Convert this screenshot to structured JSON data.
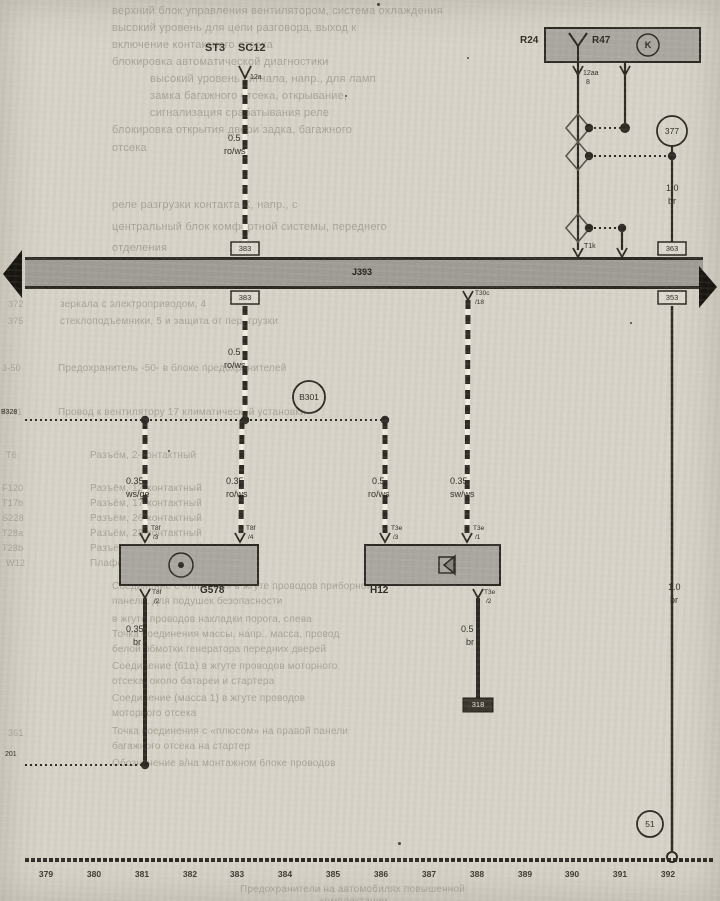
{
  "fuse": {
    "st3": "ST3",
    "sc12": "SC12",
    "pin": "12a"
  },
  "relay": {
    "r24": "R24",
    "r47": "R47",
    "k": "K",
    "pin": "12aa",
    "pin_n": "8"
  },
  "bus": {
    "label": "J393",
    "pin_t1k": "T1k",
    "pin_t30c": "T30c",
    "pin_t30c_n": "/18",
    "ref_left_above": "383",
    "ref_left_below": "383",
    "ref_right_above": "363",
    "ref_right_below": "353"
  },
  "sensor": {
    "label": "G578",
    "pin_tl": "T8f",
    "pin_tl_n": "/3",
    "pin_tr": "T8f",
    "pin_tr_n": "/4",
    "pin_b": "T8f",
    "pin_b_n": "/2"
  },
  "horn": {
    "label": "H12",
    "pin_tl": "T3e",
    "pin_tl_n": "/3",
    "pin_tr": "T3e",
    "pin_tr_n": "/1",
    "pin_b": "T3e",
    "pin_b_n": "/2",
    "end_ref": "318"
  },
  "splices": {
    "b301": "B301",
    "b328": "B328",
    "left_bottom": "201",
    "c377": "377",
    "c51": "51"
  },
  "wires": {
    "w1": {
      "g": "0.5",
      "c": "ro/ws"
    },
    "w2": {
      "g": "0.5",
      "c": "ro/ws"
    },
    "w3": {
      "g": "0.35",
      "c": "ws/ge"
    },
    "w4": {
      "g": "0.35",
      "c": "ro/ws"
    },
    "w5": {
      "g": "0.5",
      "c": "ro/ws"
    },
    "w6": {
      "g": "0.35",
      "c": "sw/ws"
    },
    "w7": {
      "g": "0.35",
      "c": "br"
    },
    "w8": {
      "g": "0.5",
      "c": "br"
    },
    "w9": {
      "g": "1.0",
      "c": "br"
    },
    "w10": {
      "g": "1.0",
      "c": "br"
    }
  },
  "tracks": [
    {
      "x": 46,
      "t": "379"
    },
    {
      "x": 94,
      "t": "380"
    },
    {
      "x": 142,
      "t": "381"
    },
    {
      "x": 190,
      "t": "382"
    },
    {
      "x": 237,
      "t": "383"
    },
    {
      "x": 285,
      "t": "384"
    },
    {
      "x": 333,
      "t": "385"
    },
    {
      "x": 381,
      "t": "386"
    },
    {
      "x": 429,
      "t": "387"
    },
    {
      "x": 477,
      "t": "388"
    },
    {
      "x": 525,
      "t": "389"
    },
    {
      "x": 572,
      "t": "390"
    },
    {
      "x": 620,
      "t": "391"
    },
    {
      "x": 668,
      "t": "392"
    }
  ],
  "ghost": {
    "lines": [
      {
        "x": 112,
        "y": 5,
        "s": 11,
        "t": "верхний блок управления вентилятором, система охлаждения"
      },
      {
        "x": 112,
        "y": 22,
        "s": 11,
        "t": "высокий уровень для цепи разговора, выход к"
      },
      {
        "x": 112,
        "y": 39,
        "s": 11,
        "t": "включение контактного отсека"
      },
      {
        "x": 112,
        "y": 56,
        "s": 11,
        "t": "блокировка автоматической диагностики"
      },
      {
        "x": 150,
        "y": 73,
        "s": 11,
        "t": "высокий уровень сигнала, напр., для ламп"
      },
      {
        "x": 150,
        "y": 90,
        "s": 11,
        "t": "замка багажного отсека, открывание,"
      },
      {
        "x": 150,
        "y": 107,
        "s": 11,
        "t": "сигнализация срабатывания реле"
      },
      {
        "x": 112,
        "y": 124,
        "s": 11,
        "t": "блокировка открытия двери задка, багажного"
      },
      {
        "x": 112,
        "y": 142,
        "s": 11,
        "t": "отсека"
      },
      {
        "x": 112,
        "y": 199,
        "s": 11,
        "t": "реле разгрузки контакта X, напр., с"
      },
      {
        "x": 112,
        "y": 221,
        "s": 11,
        "t": "центральный блок комфортной системы, переднего"
      },
      {
        "x": 112,
        "y": 242,
        "s": 11,
        "t": "отделения"
      },
      {
        "x": 60,
        "y": 299,
        "t": "зеркала с электроприводом, 4"
      },
      {
        "x": 60,
        "y": 316,
        "t": "стеклоподъемники, 5 и защита от перегрузки"
      },
      {
        "x": 58,
        "y": 363,
        "t": "Предохранитель -50- в блоке предохранителей"
      },
      {
        "x": 58,
        "y": 407,
        "t": "Провод к вентилятору 17 климатической установки"
      },
      {
        "x": 90,
        "y": 450,
        "t": "Разъём, 2-контактный"
      },
      {
        "x": 90,
        "y": 483,
        "t": "Разъём, 12-контактный"
      },
      {
        "x": 90,
        "y": 498,
        "t": "Разъём, 17-контактный"
      },
      {
        "x": 90,
        "y": 513,
        "t": "Разъём, 26-контактный"
      },
      {
        "x": 90,
        "y": 528,
        "t": "Разъём, 28-контактный"
      },
      {
        "x": 90,
        "y": 543,
        "t": "Разъём, 28-контактный, белый"
      },
      {
        "x": 90,
        "y": 558,
        "t": "Плафон освещения салона"
      },
      {
        "x": 112,
        "y": 581,
        "t": "Соединение с «плюсом» в жгуте проводов приборной"
      },
      {
        "x": 112,
        "y": 596,
        "t": "панели, для подушек безопасности"
      },
      {
        "x": 112,
        "y": 614,
        "t": "в жгуте проводов накладки порога, слева"
      },
      {
        "x": 112,
        "y": 629,
        "t": "Точка соединения массы, напр., масса, провод"
      },
      {
        "x": 112,
        "y": 644,
        "t": "белой обмотки генератора передних дверей"
      },
      {
        "x": 112,
        "y": 661,
        "t": "Соединение (61а) в жгуте проводов моторного"
      },
      {
        "x": 112,
        "y": 676,
        "t": "отсека, около батареи и стартера"
      },
      {
        "x": 112,
        "y": 693,
        "t": "Соединение (масса 1) в жгуте проводов"
      },
      {
        "x": 112,
        "y": 708,
        "t": "моторного отсека"
      },
      {
        "x": 112,
        "y": 726,
        "t": "Точка соединения с «плюсом» на правой панели"
      },
      {
        "x": 112,
        "y": 741,
        "t": "багажного отсека на стартер"
      },
      {
        "x": 112,
        "y": 758,
        "t": "Обозначение в/на монтажном блоке проводов"
      },
      {
        "x": 240,
        "y": 884,
        "t": "Предохранители на автомобилях повышенной"
      },
      {
        "x": 320,
        "y": 896,
        "t": "комплектации"
      }
    ],
    "codes": [
      {
        "x": 8,
        "y": 299,
        "t": "372"
      },
      {
        "x": 8,
        "y": 316,
        "t": "375"
      },
      {
        "x": 2,
        "y": 363,
        "t": "3-50"
      },
      {
        "x": 2,
        "y": 407,
        "t": "R-41"
      },
      {
        "x": 6,
        "y": 450,
        "t": "Т6"
      },
      {
        "x": 2,
        "y": 483,
        "t": "F120"
      },
      {
        "x": 2,
        "y": 498,
        "t": "Т17b"
      },
      {
        "x": 2,
        "y": 513,
        "t": "S228"
      },
      {
        "x": 2,
        "y": 528,
        "t": "Т28а"
      },
      {
        "x": 2,
        "y": 543,
        "t": "Т28b"
      },
      {
        "x": 6,
        "y": 558,
        "t": "W12"
      },
      {
        "x": 8,
        "y": 728,
        "t": "361"
      }
    ]
  }
}
